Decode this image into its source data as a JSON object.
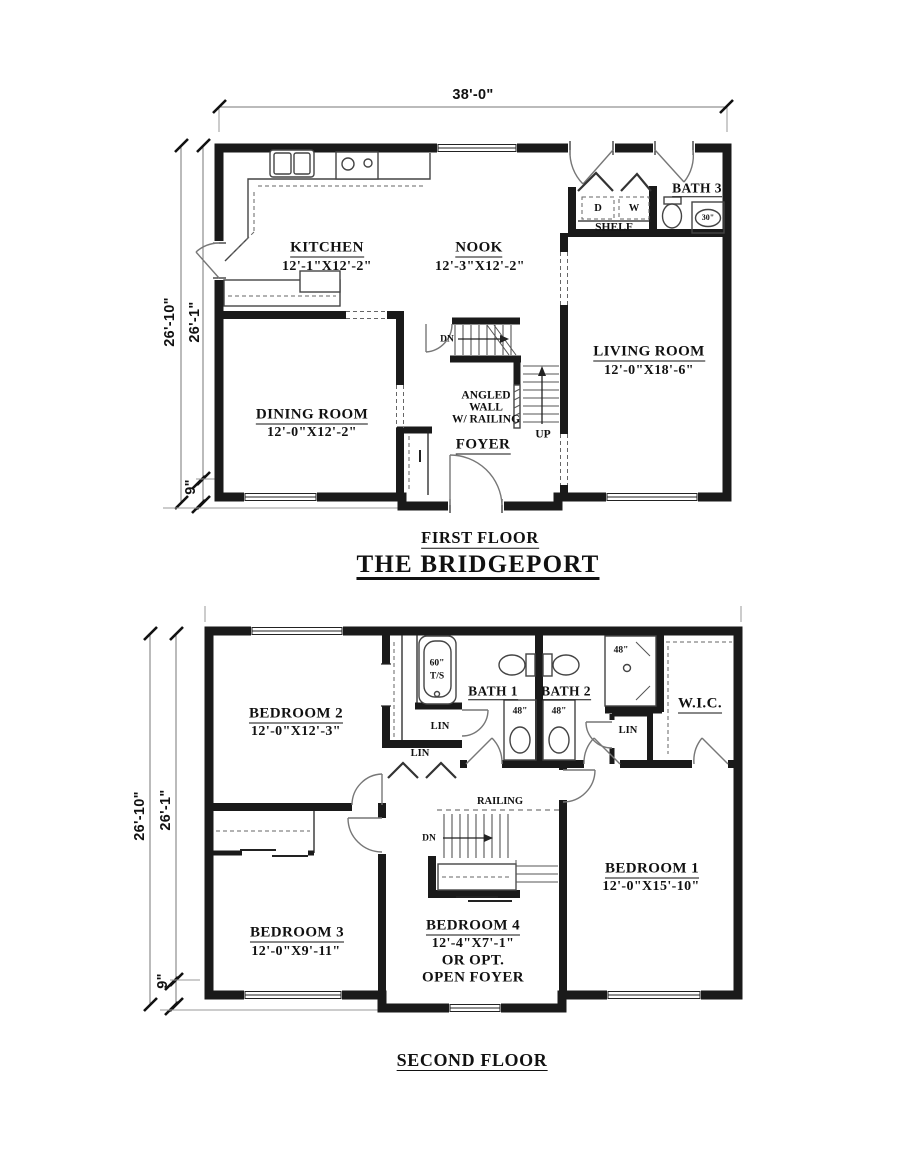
{
  "sheet": {
    "first_floor_label": "FIRST FLOOR",
    "plan_name": "THE BRIDGEPORT",
    "second_floor_label": "SECOND FLOOR"
  },
  "first_floor": {
    "dims": {
      "width": "38'-0\"",
      "depth_outer": "26'-10\"",
      "depth_inner": "26'-1\"",
      "offset": "9\""
    },
    "rooms": {
      "kitchen": {
        "name": "KITCHEN",
        "size": "12'-1\"X12'-2\""
      },
      "nook": {
        "name": "NOOK",
        "size": "12'-3\"X12'-2\""
      },
      "bath3": {
        "name": "BATH 3"
      },
      "living": {
        "name": "LIVING ROOM",
        "size": "12'-0\"X18'-6\""
      },
      "dining": {
        "name": "DINING ROOM",
        "size": "12'-0\"X12'-2\""
      },
      "foyer": {
        "name": "FOYER"
      }
    },
    "labels": {
      "dryer": "D",
      "washer": "W",
      "shelf": "SHELF",
      "shower_size": "30\"",
      "stairs_down": "DN",
      "stairs_up": "UP",
      "angled_line1": "ANGLED",
      "angled_line2": "WALL",
      "angled_line3": "W/ RAILING"
    }
  },
  "second_floor": {
    "dims": {
      "depth_outer": "26'-10\"",
      "depth_inner": "26'-1\"",
      "offset": "9\""
    },
    "rooms": {
      "bedroom1": {
        "name": "BEDROOM 1",
        "size": "12'-0\"X15'-10\""
      },
      "bedroom2": {
        "name": "BEDROOM 2",
        "size": "12'-0\"X12'-3\""
      },
      "bedroom3": {
        "name": "BEDROOM 3",
        "size": "12'-0\"X9'-11\""
      },
      "bedroom4": {
        "name": "BEDROOM 4",
        "size": "12'-4\"X7'-1\"",
        "opt_line1": "OR OPT.",
        "opt_line2": "OPEN FOYER"
      },
      "bath1": {
        "name": "BATH 1"
      },
      "bath2": {
        "name": "BATH 2"
      },
      "wic": {
        "name": "W.I.C."
      }
    },
    "labels": {
      "tub_size": "60\"",
      "tub_type": "T/S",
      "shower_size": "48\"",
      "vanity1_size": "48\"",
      "vanity2_size": "48\"",
      "linen1": "LIN",
      "linen2": "LIN",
      "linen3": "LIN",
      "railing": "RAILING",
      "stairs_down": "DN"
    }
  }
}
